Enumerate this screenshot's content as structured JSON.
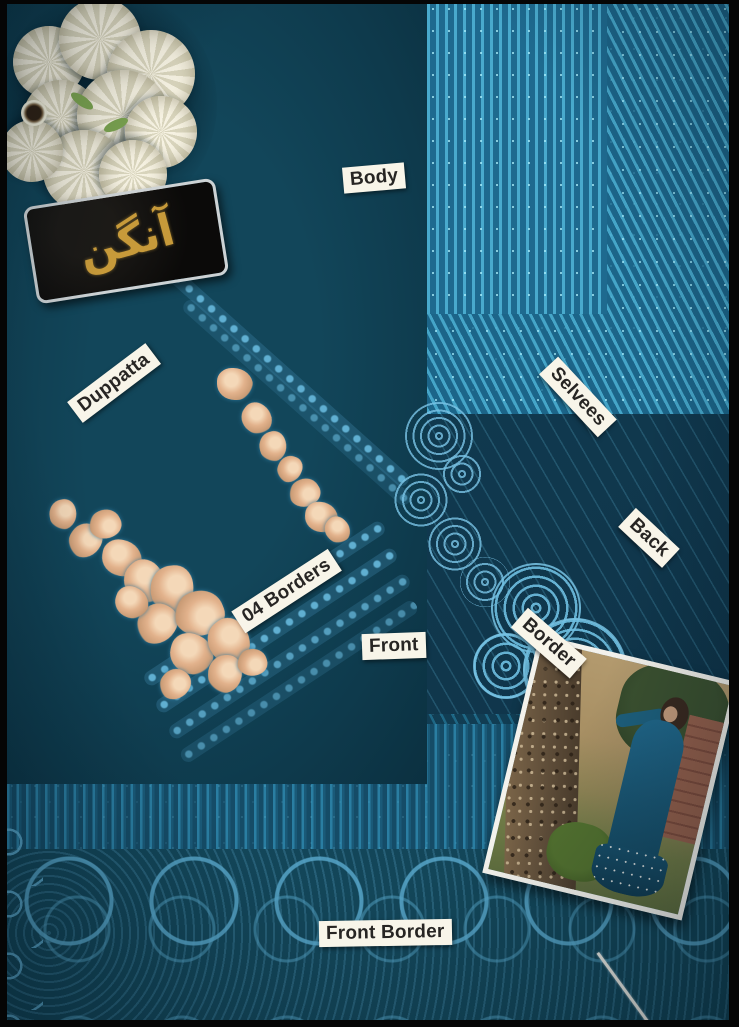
{
  "meta": {
    "type": "product-photo",
    "subject": "Flat-lay of an unstitched teal-blue sequinned embroidered fabric suit with paper labels naming each piece"
  },
  "brand": {
    "name": "آنگن"
  },
  "labels": {
    "body": "Body",
    "duppatta": "Duppatta",
    "selvees": "Selvees",
    "back": "Back",
    "border": "Border",
    "borders_04": "04 Borders",
    "front": "Front",
    "front_border": "Front Border"
  },
  "colors": {
    "fabric_bright": "#45a5c8",
    "fabric_mid": "#2a7ea2",
    "fabric_dark": "#0e3a4c",
    "lace_blue": "#5fb0d8",
    "applique_gold": "#e2b28c",
    "label_paper": "#f8f5e9",
    "label_text": "#272523",
    "brand_gold": "#c79a3a",
    "frame": "#050505"
  }
}
